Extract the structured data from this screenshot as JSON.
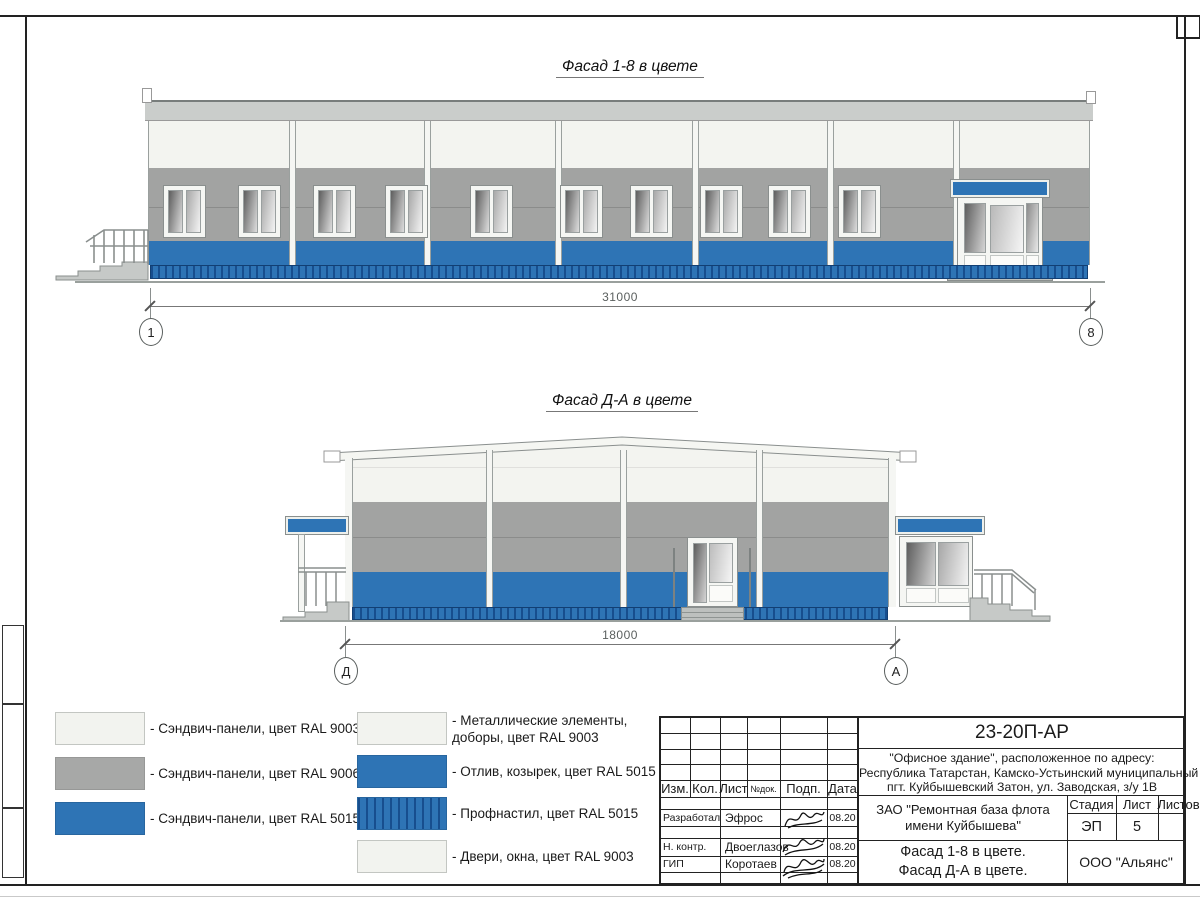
{
  "titles": {
    "facade1": "Фасад 1-8 в цвете",
    "facade2": "Фасад Д-А в цвете"
  },
  "dimensions": {
    "facade1": {
      "value": "31000",
      "axis_left": "1",
      "axis_right": "8"
    },
    "facade2": {
      "value": "18000",
      "axis_left": "Д",
      "axis_right": "А"
    }
  },
  "facades": {
    "facade_1_8": {
      "window_x": [
        163,
        238,
        313,
        385,
        470,
        560,
        630,
        700,
        768,
        838
      ],
      "pillar_x": [
        289,
        424,
        555,
        692,
        827,
        953
      ]
    },
    "facade_D_A": {
      "pillar_x": [
        486,
        620,
        756
      ]
    }
  },
  "legend": {
    "items": [
      {
        "type": "white",
        "x": 55,
        "y": 712,
        "label": "- Сэндвич-панели, цвет RAL 9003"
      },
      {
        "type": "gray",
        "x": 55,
        "y": 757,
        "label": "- Сэндвич-панели, цвет RAL 9006"
      },
      {
        "type": "blue",
        "x": 55,
        "y": 802,
        "label": "- Сэндвич-панели, цвет RAL 5015"
      },
      {
        "type": "white",
        "x": 357,
        "y": 712,
        "label": "- Металлические элементы,\nдоборы, цвет RAL 9003"
      },
      {
        "type": "blue",
        "x": 357,
        "y": 755,
        "label": "- Отлив, козырек, цвет RAL 5015"
      },
      {
        "type": "corrugated",
        "x": 357,
        "y": 797,
        "label": "- Профнастил, цвет RAL 5015"
      },
      {
        "type": "white",
        "x": 357,
        "y": 840,
        "label": "- Двери, окна, цвет RAL 9003"
      }
    ]
  },
  "title_block": {
    "doc_number": "23-20П-АР",
    "address": [
      "\"Офисное здание\", расположенное по адресу:",
      "Республика Татарстан, Камско-Устьинский муниципальный район,",
      "пгт. Куйбышевский Затон, ул. Заводская, з/у 1В"
    ],
    "columns": [
      "Изм.",
      "Кол.",
      "Лист",
      "№док.",
      "Подп.",
      "Дата"
    ],
    "roles": [
      {
        "role": "Разработал",
        "name": "Эфрос",
        "date": "08.20"
      },
      {
        "role": "Н. контр.",
        "name": "Двоеглазов",
        "date": "08.20"
      },
      {
        "role": "ГИП",
        "name": "Коротаев",
        "date": "08.20"
      }
    ],
    "client": [
      "ЗАО \"Ремонтная база флота",
      "имени Куйбышева\""
    ],
    "stage_label": "Стадия",
    "sheet_label": "Лист",
    "sheets_label": "Листов",
    "stage_value": "ЭП",
    "sheet_value": "5",
    "sheet_title": [
      "Фасад 1-8 в цвете.",
      "Фасад Д-А в цвете."
    ],
    "company": "ООО \"Альянс\""
  },
  "colors": {
    "ral5015_blue": "#2E74B5",
    "ral9006_gray": "#A2A3A2",
    "ral9003_white": "#F3F4F0",
    "corrugated_dark": "#174E8E"
  }
}
